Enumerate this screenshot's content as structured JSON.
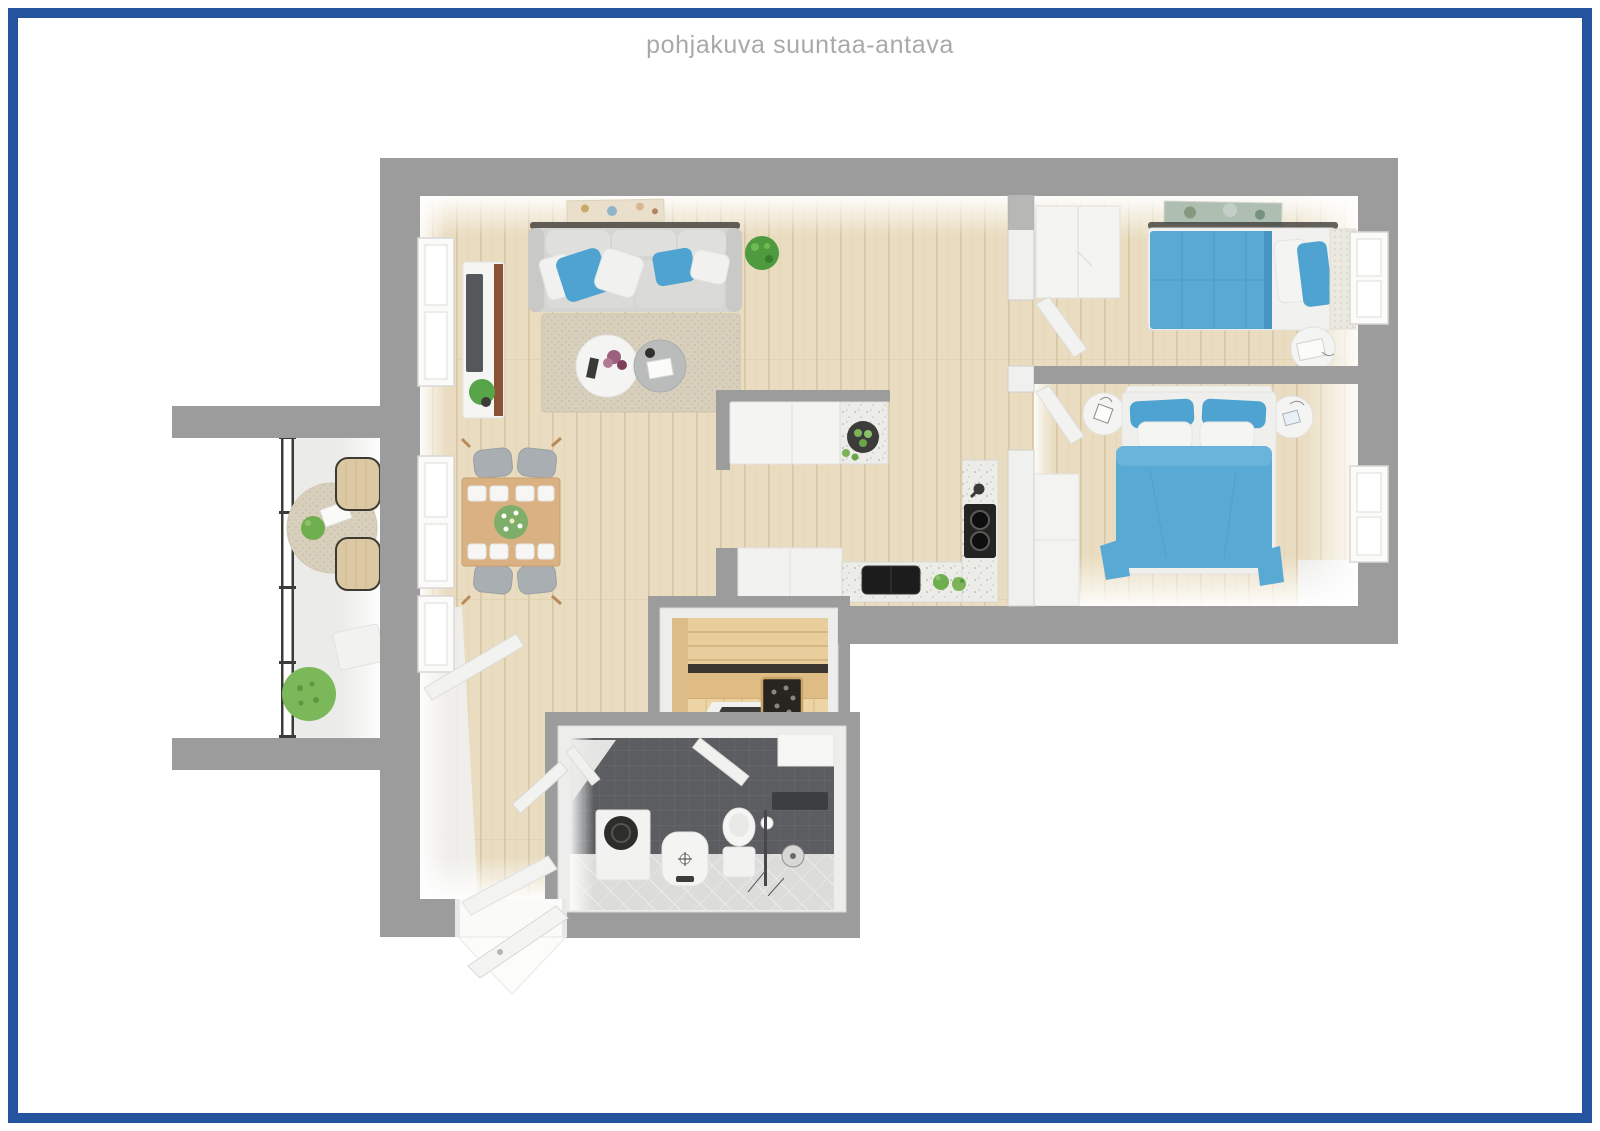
{
  "page": {
    "title": "pohjakuva suuntaa-antava"
  },
  "palette": {
    "navy": "#24549e",
    "title_gray": "#a9a9a9",
    "wall_gray": "#9c9c9c",
    "furniture_white": "#f3f3f1",
    "floor_wood": "#e9dcc0",
    "floor_wood_line": "#d9c6a2",
    "rug_beige": "#d8d0bd",
    "sofa_gray": "#d5d5d3",
    "bed_blue": "#58a9d3",
    "pillow_blue": "#4fa3d0",
    "dining_wood": "#d9b183",
    "chair_gray": "#a9aeb2",
    "tv_wood_brown": "#8b5137",
    "counter_speckle": "#ecece8",
    "appliance_black": "#242422",
    "tile_wall_dark": "#5b5d60",
    "tile_floor_light": "#dcdcda",
    "sauna_wood": "#e8cd9d",
    "sauna_wood_dark": "#cfae78",
    "plant_green": "#5da344",
    "balcony_chair_beige": "#dcc9a4",
    "glass_frame_dark": "#3b3b39"
  },
  "floor_plan": {
    "style": "3d-top-down-render",
    "rooms": [
      {
        "name": "living-room",
        "furniture": [
          "sofa",
          "throw-pillows",
          "area-rug",
          "coffee-table",
          "side-table",
          "tv-stand",
          "tv",
          "potted-plant",
          "wall-art"
        ]
      },
      {
        "name": "dining-area",
        "furniture": [
          "dining-table",
          "dining-chairs-x4",
          "table-settings",
          "flower-centerpiece"
        ]
      },
      {
        "name": "kitchen",
        "furniture": [
          "island",
          "fruit-bowl",
          "base-cabinets",
          "l-countertop",
          "cooktop",
          "sink",
          "faucet",
          "herb-pots"
        ]
      },
      {
        "name": "bedroom-1",
        "furniture": [
          "single-bed-blue",
          "wardrobe",
          "round-nightstand",
          "wall-art",
          "window"
        ]
      },
      {
        "name": "bedroom-2",
        "furniture": [
          "double-bed-blue",
          "round-nightstands-x2",
          "wardrobe",
          "window"
        ]
      },
      {
        "name": "sauna",
        "furniture": [
          "wood-benches",
          "sauna-heater",
          "floor-drain"
        ]
      },
      {
        "name": "bathroom",
        "furniture": [
          "washing-machine",
          "pedestal-sink",
          "toilet",
          "shower-set",
          "shelf",
          "dark-tile-wall"
        ]
      },
      {
        "name": "balcony",
        "furniture": [
          "glass-railing-4-panels",
          "round-rug",
          "lounge-chairs-x2",
          "tray-table",
          "plants"
        ]
      },
      {
        "name": "entrance-hall",
        "furniture": [
          "front-door-open",
          "bathroom-door-open",
          "balcony-door-open"
        ]
      }
    ]
  }
}
